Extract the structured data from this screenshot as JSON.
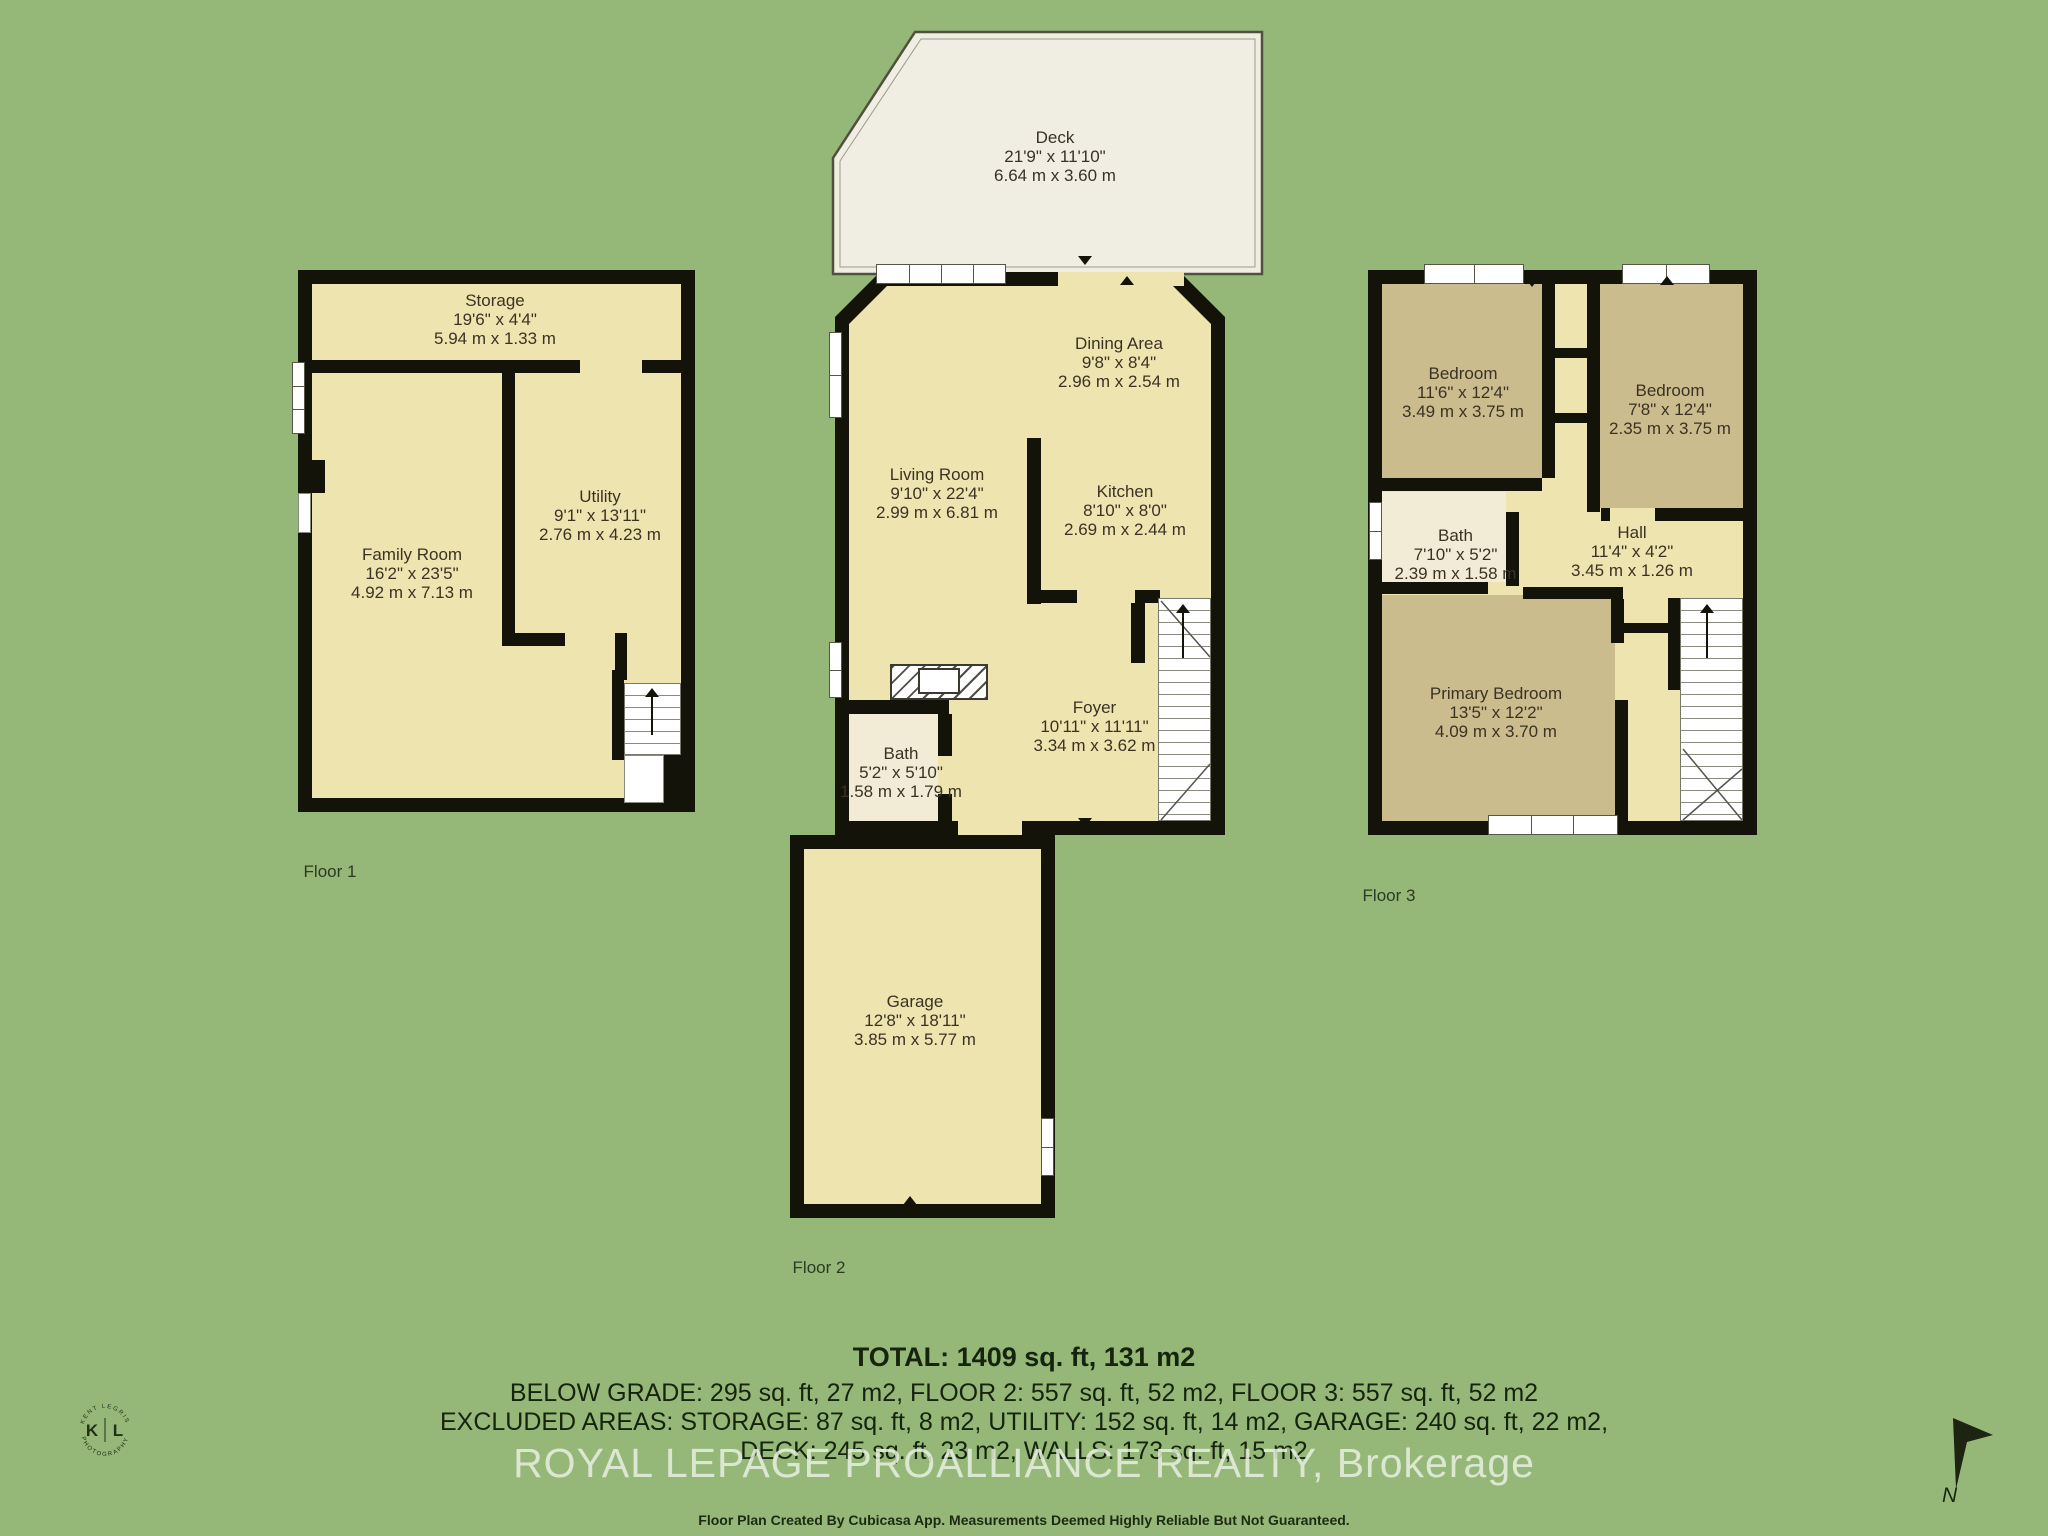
{
  "colors": {
    "background": "#95b878",
    "floor_fill": "#eee4b0",
    "dark_room_fill": "#cbbc8e",
    "light_room_fill": "#f2ecd7",
    "deck_fill": "#f0ede2",
    "wall": "#131309",
    "room_text": "#3a3323",
    "summary_text": "#16230e",
    "watermark_text": "#e9efe2"
  },
  "deck": {
    "name": "Deck",
    "ft": "21'9\" x 11'10\"",
    "m": "6.64 m x 3.60 m"
  },
  "floor1": {
    "label": "Floor 1",
    "storage": {
      "name": "Storage",
      "ft": "19'6\" x 4'4\"",
      "m": "5.94 m x 1.33 m"
    },
    "family": {
      "name": "Family Room",
      "ft": "16'2\" x 23'5\"",
      "m": "4.92 m x 7.13 m"
    },
    "utility": {
      "name": "Utility",
      "ft": "9'1\" x 13'11\"",
      "m": "2.76 m x 4.23 m"
    }
  },
  "floor2": {
    "label": "Floor 2",
    "living": {
      "name": "Living Room",
      "ft": "9'10\" x 22'4\"",
      "m": "2.99 m x 6.81 m"
    },
    "dining": {
      "name": "Dining Area",
      "ft": "9'8\" x 8'4\"",
      "m": "2.96 m x 2.54 m"
    },
    "kitchen": {
      "name": "Kitchen",
      "ft": "8'10\" x 8'0\"",
      "m": "2.69 m x 2.44 m"
    },
    "foyer": {
      "name": "Foyer",
      "ft": "10'11\" x 11'11\"",
      "m": "3.34 m x 3.62 m"
    },
    "bath": {
      "name": "Bath",
      "ft": "5'2\" x 5'10\"",
      "m": "1.58 m x 1.79 m"
    },
    "garage": {
      "name": "Garage",
      "ft": "12'8\" x 18'11\"",
      "m": "3.85 m x 5.77 m"
    }
  },
  "floor3": {
    "label": "Floor 3",
    "bedroom1": {
      "name": "Bedroom",
      "ft": "11'6\" x 12'4\"",
      "m": "3.49 m x 3.75 m"
    },
    "bedroom2": {
      "name": "Bedroom",
      "ft": "7'8\" x 12'4\"",
      "m": "2.35 m x 3.75 m"
    },
    "bath": {
      "name": "Bath",
      "ft": "7'10\" x 5'2\"",
      "m": "2.39 m x 1.58 m"
    },
    "hall": {
      "name": "Hall",
      "ft": "11'4\" x 4'2\"",
      "m": "3.45 m x 1.26 m"
    },
    "primary": {
      "name": "Primary Bedroom",
      "ft": "13'5\" x 12'2\"",
      "m": "4.09 m x 3.70 m"
    }
  },
  "summary": {
    "total": "TOTAL: 1409 sq. ft, 131 m2",
    "line2": "BELOW GRADE: 295 sq. ft, 27 m2, FLOOR 2: 557 sq. ft, 52 m2, FLOOR 3: 557 sq. ft, 52 m2",
    "line3": "EXCLUDED AREAS: STORAGE: 87 sq. ft, 8 m2, UTILITY: 152 sq. ft, 14 m2, GARAGE: 240 sq. ft, 22 m2,",
    "line4": "DECK: 245 sq. ft, 23 m2, WALLS: 173 sq. ft, 15 m2"
  },
  "watermark": "ROYAL LEPAGE PROALLIANCE REALTY, Brokerage",
  "disclaimer": "Floor Plan Created By Cubicasa App. Measurements Deemed Highly Reliable But Not Guaranteed.",
  "logo": {
    "k": "K",
    "l": "L",
    "arc_top": "KENT LEGRIS",
    "arc_bottom": "PHOTOGRAPHY"
  },
  "compass": {
    "n": "N"
  }
}
